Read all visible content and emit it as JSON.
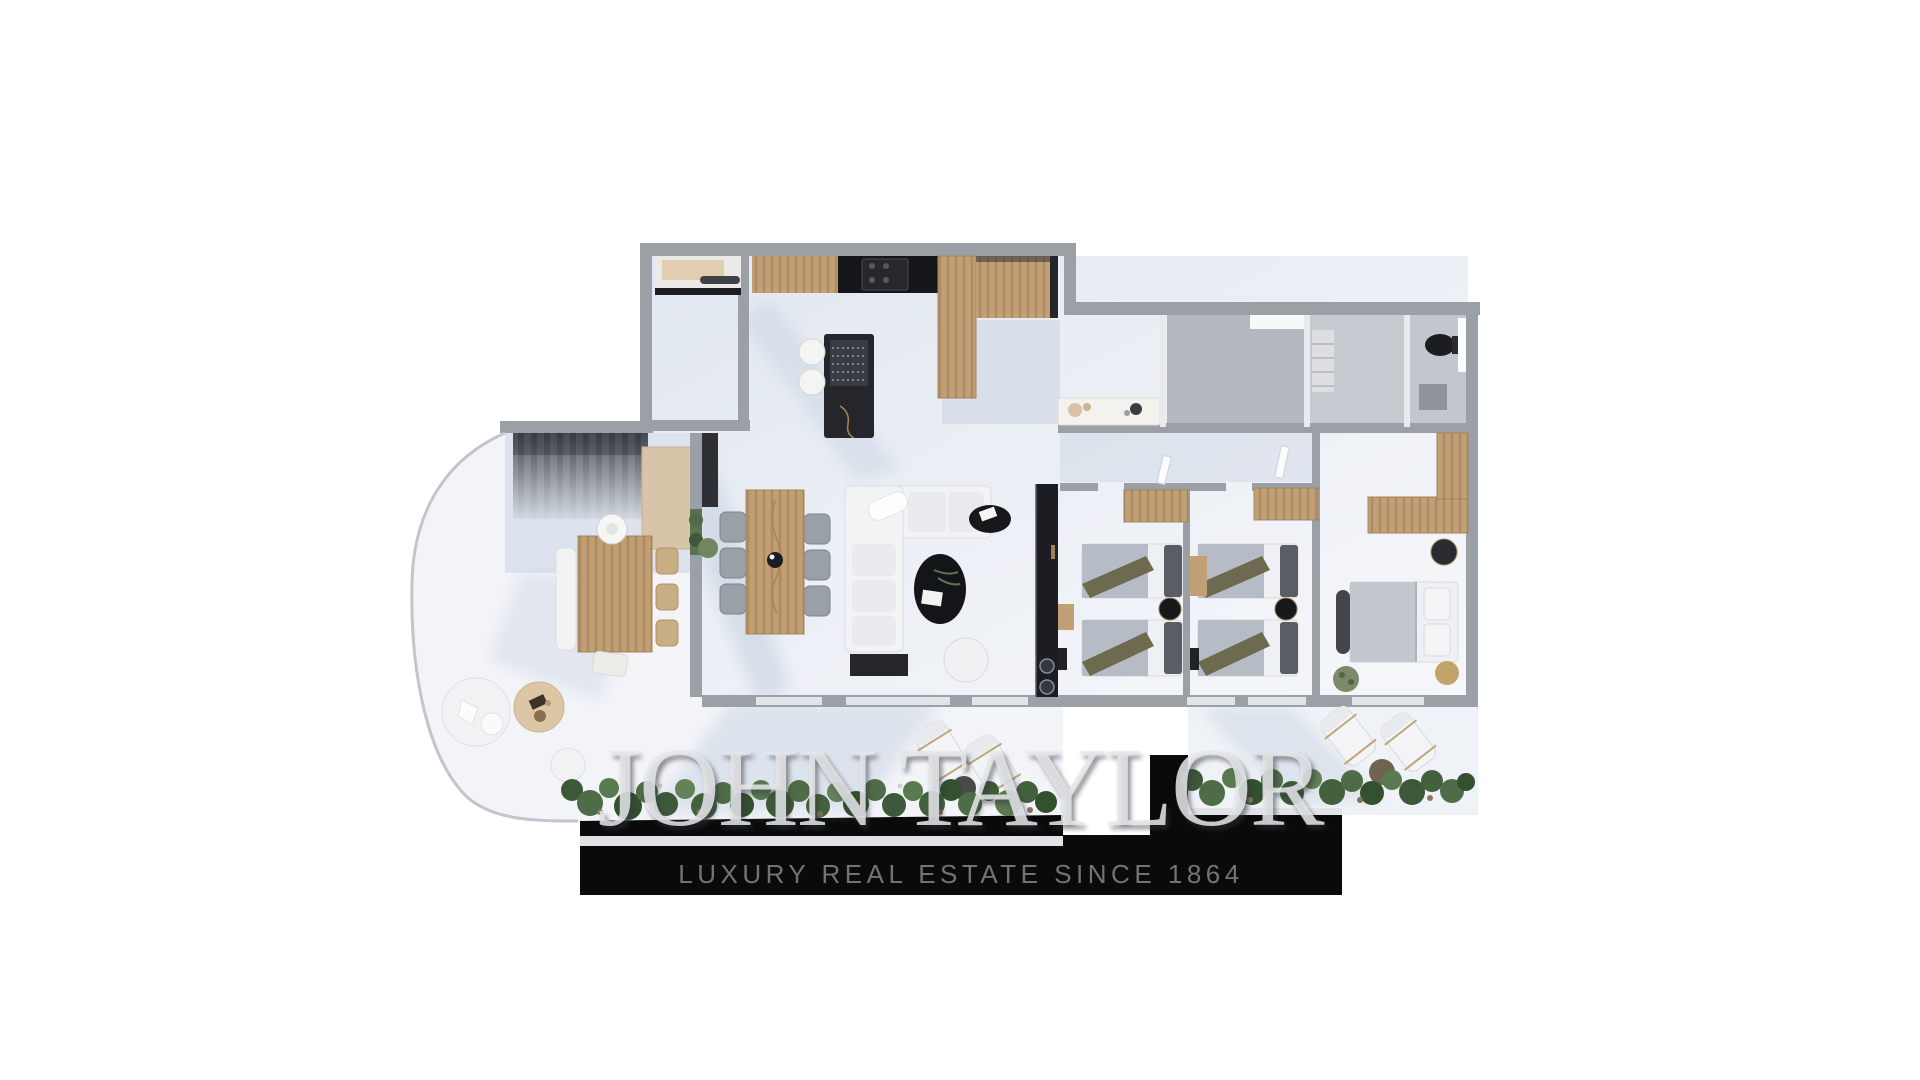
{
  "brand": {
    "wordmark": "JOHN TAYLOR",
    "tagline": "LUXURY REAL ESTATE SINCE 1864",
    "bar_color": "#0a0a0a",
    "wordmark_color": "rgba(229,230,233,0.86)",
    "tagline_color": "#737376"
  },
  "floorplan": {
    "type": "3d-top-down-apartment-render",
    "palette": {
      "wall_gray": "#9aa0a6",
      "wood": "#c2a076",
      "floor_light": "#eef1f6",
      "floor_shadow": "#c7d0e0",
      "black_furniture": "#1d1f24",
      "greenery": "#4e6c47",
      "khaki_throw": "#6e6a4f",
      "beige": "#dcc6a4"
    },
    "rooms": [
      "kitchen",
      "utility-room",
      "staircase",
      "living-dining-room",
      "hallway",
      "shower-room",
      "bathroom",
      "wc",
      "bedroom-1",
      "bedroom-2",
      "master-bedroom",
      "outdoor-dining-terrace",
      "lounge-terrace",
      "sun-deck"
    ],
    "furniture": [
      "kitchen-island",
      "bar-stools",
      "dining-table",
      "dining-chairs",
      "corner-sofa",
      "coffee-table",
      "tv-console",
      "twin-beds",
      "double-bed",
      "wardrobes",
      "sun-loungers",
      "round-poufs",
      "planter-hedge",
      "stairs",
      "console-table",
      "toilet"
    ]
  }
}
